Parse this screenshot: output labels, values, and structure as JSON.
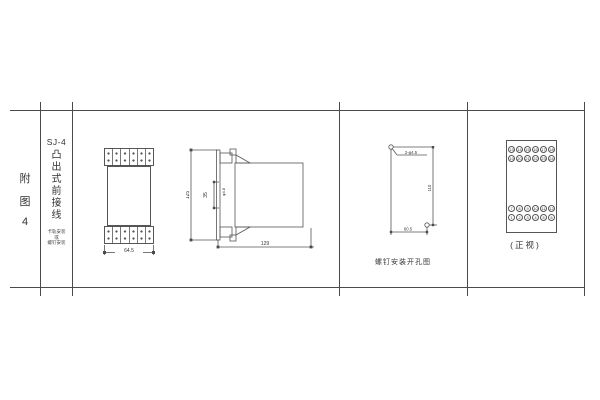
{
  "sheet": {
    "background": "#ffffff",
    "line_color": "#4a4a4a",
    "text_color": "#333333"
  },
  "index_column": {
    "chars": [
      "附",
      "图",
      "4"
    ]
  },
  "title_column": {
    "model": "SJ-4",
    "type_chars": [
      "凸",
      "出",
      "式",
      "前",
      "接",
      "线"
    ],
    "mount_lines": [
      "卡轨安装",
      "或",
      "螺钉安装"
    ]
  },
  "front_view": {
    "width_dim": "64.5"
  },
  "side_view": {
    "height_dim": "125",
    "depth_dim": "129",
    "rail_dim": "35",
    "hole_label": "φ4.8"
  },
  "drill_view": {
    "holes_label": "2-φ4.5",
    "height_dim": "110",
    "width_dim": "60.5",
    "caption": "螺钉安装开孔图"
  },
  "terminal_view": {
    "caption": "(正视)",
    "top_rows": [
      [
        "13",
        "14",
        "15",
        "16",
        "17",
        "18"
      ],
      [
        "19",
        "20",
        "21",
        "22",
        "23",
        "24"
      ]
    ],
    "bottom_rows": [
      [
        "7",
        "8",
        "9",
        "10",
        "11",
        "12"
      ],
      [
        "1",
        "2",
        "3",
        "4",
        "5",
        "6"
      ]
    ]
  }
}
